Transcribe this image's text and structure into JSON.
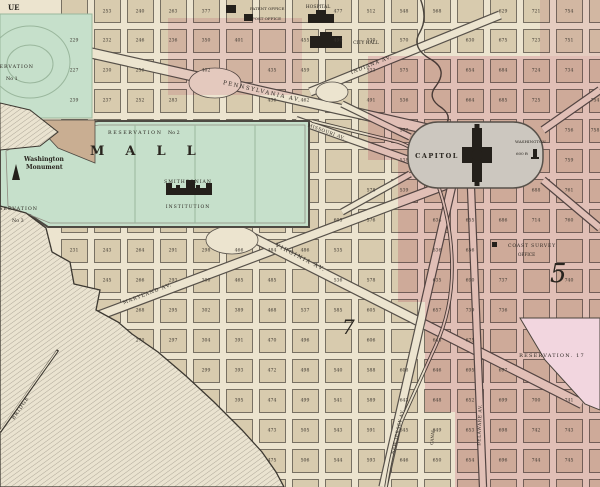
{
  "labels": {
    "corner_fragment": "UE",
    "reservation1": "RESERVATION",
    "reservation1_no": "No 1",
    "reservation2": "RESERVATION",
    "reservation2_no": "No 2",
    "reservation3": "RESERVATION",
    "reservation3_no": "No 3",
    "mall": "MALL",
    "monument_1": "Washington",
    "monument_2": "Monument",
    "smithsonian_1": "SMITHSONIAN",
    "smithsonian_2": "INSTITUTION",
    "hospital": "HOSPITAL",
    "patent_office": "PATENT OFFICE",
    "post_office": "POST OFFICE",
    "city_hall": "CITY HALL",
    "capitol": "CAPITOL",
    "washington": "WASHINGTON",
    "capitol_height": "600 ft",
    "coast_survey": "COAST SURVEY",
    "coast_office": "OFFICE",
    "reservation17": "RESERVATION. 17",
    "bridge": "BRIDGE",
    "canal": "CANAL",
    "ward5": "5",
    "ward7": "7"
  },
  "palette": {
    "paper": "#ece4cf",
    "block_tan": "#d8cbae",
    "green": "#c6e0cb",
    "pink": "#e39cb8",
    "pink_light": "#f2d6df",
    "capitol_gray": "#ccc7bf",
    "ink": "#2e2a24",
    "water_line": "#a19a8c"
  },
  "grid": {
    "x0": 58,
    "y0": -4,
    "px": 33,
    "py": 30,
    "cols": 17,
    "rows": 17,
    "gap": 3.5
  },
  "avenues": [
    {
      "name": "pennsylvania-avenue",
      "label": "PENNSYLVANIA AV.",
      "x1": 78,
      "y1": 50,
      "x2": 445,
      "y2": 133,
      "w": 9,
      "lx": 262,
      "ly": 93,
      "rot": 13,
      "ls": 1.5,
      "fs": 5.5
    },
    {
      "name": "indiana-avenue",
      "label": "INDIANA AV.",
      "x1": 310,
      "y1": 92,
      "x2": 500,
      "y2": 15,
      "w": 7,
      "lx": 372,
      "ly": 66,
      "rot": -22,
      "ls": 1,
      "fs": 5
    },
    {
      "name": "missouri-avenue",
      "label": "MISSOURI AV.",
      "x1": 296,
      "y1": 120,
      "x2": 420,
      "y2": 164,
      "w": 6,
      "lx": 326,
      "ly": 133,
      "rot": 20,
      "ls": 0.5,
      "fs": 4.5
    },
    {
      "name": "maryland-avenue",
      "label": "MARYLAND AV.",
      "x1": 55,
      "y1": 332,
      "x2": 448,
      "y2": 184,
      "w": 8,
      "lx": 148,
      "ly": 295,
      "rot": -21,
      "ls": 1,
      "fs": 5
    },
    {
      "name": "virginia-avenue",
      "label": "VIRGINIA AV.",
      "x1": 222,
      "y1": 222,
      "x2": 582,
      "y2": 404,
      "w": 8,
      "lx": 300,
      "ly": 259,
      "rot": 27,
      "ls": 1.5,
      "fs": 5.5
    },
    {
      "name": "new-jersey-avenue",
      "label": "NEW JERSEY AV.",
      "x1": 452,
      "y1": 185,
      "x2": 383,
      "y2": 487,
      "w": 7,
      "lx": 399,
      "ly": 432,
      "rot": -77,
      "ls": 0.5,
      "fs": 4.5
    },
    {
      "name": "delaware-avenue",
      "label": "DELAWARE AV.",
      "x1": 471,
      "y1": 188,
      "x2": 483,
      "y2": 487,
      "w": 6,
      "lx": 481,
      "ly": 425,
      "rot": -88,
      "ls": 0.5,
      "fs": 4.5
    },
    {
      "name": "avenue-northeast-spur",
      "label": "",
      "x1": 543,
      "y1": 130,
      "x2": 600,
      "y2": 90,
      "w": 6
    },
    {
      "name": "avenue-southeast-spur",
      "label": "",
      "x1": 543,
      "y1": 180,
      "x2": 600,
      "y2": 228,
      "w": 6
    },
    {
      "name": "avenue-northwest-spur",
      "label": "",
      "x1": 410,
      "y1": 137,
      "x2": 342,
      "y2": 104,
      "w": 5
    },
    {
      "name": "avenue-southwest-spur",
      "label": "",
      "x1": 410,
      "y1": 174,
      "x2": 342,
      "y2": 212,
      "w": 5
    }
  ],
  "plazas": [
    {
      "cx": 215,
      "cy": 83,
      "rx": 26,
      "ry": 15
    },
    {
      "cx": 232,
      "cy": 240,
      "rx": 26,
      "ry": 14
    },
    {
      "cx": 332,
      "cy": 92,
      "rx": 16,
      "ry": 10
    }
  ],
  "block_numbers": [
    [
      "253",
      107,
      11
    ],
    [
      "240",
      140,
      11
    ],
    [
      "263",
      173,
      11
    ],
    [
      "377",
      206,
      11
    ],
    [
      "477",
      338,
      11
    ],
    [
      "512",
      371,
      11
    ],
    [
      "548",
      404,
      11
    ],
    [
      "568",
      437,
      11
    ],
    [
      "629",
      503,
      11
    ],
    [
      "721",
      536,
      11
    ],
    [
      "754",
      569,
      11
    ],
    [
      "229",
      74,
      40
    ],
    [
      "232",
      107,
      40
    ],
    [
      "246",
      140,
      40
    ],
    [
      "236",
      173,
      40
    ],
    [
      "350",
      206,
      40
    ],
    [
      "401",
      239,
      40
    ],
    [
      "455",
      305,
      40
    ],
    [
      "490",
      338,
      40
    ],
    [
      "530",
      371,
      40
    ],
    [
      "570",
      404,
      40
    ],
    [
      "630",
      470,
      40
    ],
    [
      "675",
      503,
      40
    ],
    [
      "723",
      536,
      40
    ],
    [
      "751",
      569,
      40
    ],
    [
      "227",
      74,
      70
    ],
    [
      "230",
      107,
      70
    ],
    [
      "256",
      140,
      70
    ],
    [
      "402",
      206,
      70
    ],
    [
      "435",
      272,
      70
    ],
    [
      "459",
      305,
      70
    ],
    [
      "533",
      371,
      70
    ],
    [
      "575",
      404,
      70
    ],
    [
      "654",
      470,
      70
    ],
    [
      "684",
      503,
      70
    ],
    [
      "724",
      536,
      70
    ],
    [
      "734",
      569,
      70
    ],
    [
      "239",
      74,
      100
    ],
    [
      "237",
      107,
      100
    ],
    [
      "252",
      140,
      100
    ],
    [
      "283",
      173,
      100
    ],
    [
      "436",
      272,
      100
    ],
    [
      "462",
      305,
      100
    ],
    [
      "491",
      371,
      100
    ],
    [
      "536",
      404,
      100
    ],
    [
      "664",
      470,
      100
    ],
    [
      "685",
      503,
      100
    ],
    [
      "725",
      536,
      100
    ],
    [
      "754",
      595,
      100
    ],
    [
      "577",
      404,
      130
    ],
    [
      "756",
      569,
      130
    ],
    [
      "758",
      595,
      130
    ],
    [
      "538",
      404,
      160
    ],
    [
      "759",
      569,
      160
    ],
    [
      "578",
      371,
      190
    ],
    [
      "539",
      404,
      190
    ],
    [
      "688",
      536,
      190
    ],
    [
      "761",
      569,
      190
    ],
    [
      "605",
      338,
      220
    ],
    [
      "576",
      371,
      220
    ],
    [
      "634",
      437,
      220
    ],
    [
      "655",
      470,
      220
    ],
    [
      "686",
      503,
      220
    ],
    [
      "714",
      536,
      220
    ],
    [
      "760",
      569,
      220
    ],
    [
      "231",
      74,
      250
    ],
    [
      "243",
      107,
      250
    ],
    [
      "264",
      140,
      250
    ],
    [
      "291",
      173,
      250
    ],
    [
      "298",
      206,
      250
    ],
    [
      "466",
      239,
      250
    ],
    [
      "484",
      272,
      250
    ],
    [
      "486",
      305,
      250
    ],
    [
      "535",
      338,
      250
    ],
    [
      "636",
      437,
      250
    ],
    [
      "656",
      470,
      250
    ],
    [
      "245",
      107,
      280
    ],
    [
      "266",
      140,
      280
    ],
    [
      "293",
      173,
      280
    ],
    [
      "300",
      206,
      280
    ],
    [
      "465",
      239,
      280
    ],
    [
      "485",
      272,
      280
    ],
    [
      "536",
      338,
      280
    ],
    [
      "578",
      371,
      280
    ],
    [
      "635",
      437,
      280
    ],
    [
      "690",
      470,
      280
    ],
    [
      "737",
      503,
      280
    ],
    [
      "740",
      569,
      280
    ],
    [
      "268",
      140,
      310
    ],
    [
      "295",
      173,
      310
    ],
    [
      "302",
      206,
      310
    ],
    [
      "389",
      239,
      310
    ],
    [
      "468",
      272,
      310
    ],
    [
      "537",
      305,
      310
    ],
    [
      "585",
      338,
      310
    ],
    [
      "605",
      371,
      310
    ],
    [
      "657",
      437,
      310
    ],
    [
      "739",
      470,
      310
    ],
    [
      "736",
      503,
      310
    ],
    [
      "270",
      140,
      340
    ],
    [
      "297",
      173,
      340
    ],
    [
      "304",
      206,
      340
    ],
    [
      "391",
      239,
      340
    ],
    [
      "470",
      272,
      340
    ],
    [
      "496",
      305,
      340
    ],
    [
      "606",
      371,
      340
    ],
    [
      "645",
      437,
      340
    ],
    [
      "675",
      470,
      340
    ],
    [
      "299",
      206,
      370
    ],
    [
      "393",
      239,
      370
    ],
    [
      "472",
      272,
      370
    ],
    [
      "498",
      305,
      370
    ],
    [
      "540",
      338,
      370
    ],
    [
      "588",
      371,
      370
    ],
    [
      "608",
      404,
      370
    ],
    [
      "646",
      437,
      370
    ],
    [
      "695",
      470,
      370
    ],
    [
      "697",
      503,
      370
    ],
    [
      "395",
      239,
      400
    ],
    [
      "474",
      272,
      400
    ],
    [
      "499",
      305,
      400
    ],
    [
      "541",
      338,
      400
    ],
    [
      "589",
      371,
      400
    ],
    [
      "643",
      404,
      400
    ],
    [
      "648",
      437,
      400
    ],
    [
      "652",
      470,
      400
    ],
    [
      "699",
      503,
      400
    ],
    [
      "700",
      536,
      400
    ],
    [
      "741",
      569,
      400
    ],
    [
      "473",
      272,
      430
    ],
    [
      "505",
      305,
      430
    ],
    [
      "543",
      338,
      430
    ],
    [
      "591",
      371,
      430
    ],
    [
      "645",
      404,
      430
    ],
    [
      "649",
      437,
      430
    ],
    [
      "653",
      470,
      430
    ],
    [
      "698",
      503,
      430
    ],
    [
      "742",
      536,
      430
    ],
    [
      "743",
      569,
      430
    ],
    [
      "475",
      272,
      460
    ],
    [
      "506",
      305,
      460
    ],
    [
      "544",
      338,
      460
    ],
    [
      "593",
      371,
      460
    ],
    [
      "646",
      404,
      460
    ],
    [
      "650",
      437,
      460
    ],
    [
      "654",
      470,
      460
    ],
    [
      "696",
      503,
      460
    ],
    [
      "744",
      536,
      460
    ],
    [
      "745",
      569,
      460
    ]
  ]
}
